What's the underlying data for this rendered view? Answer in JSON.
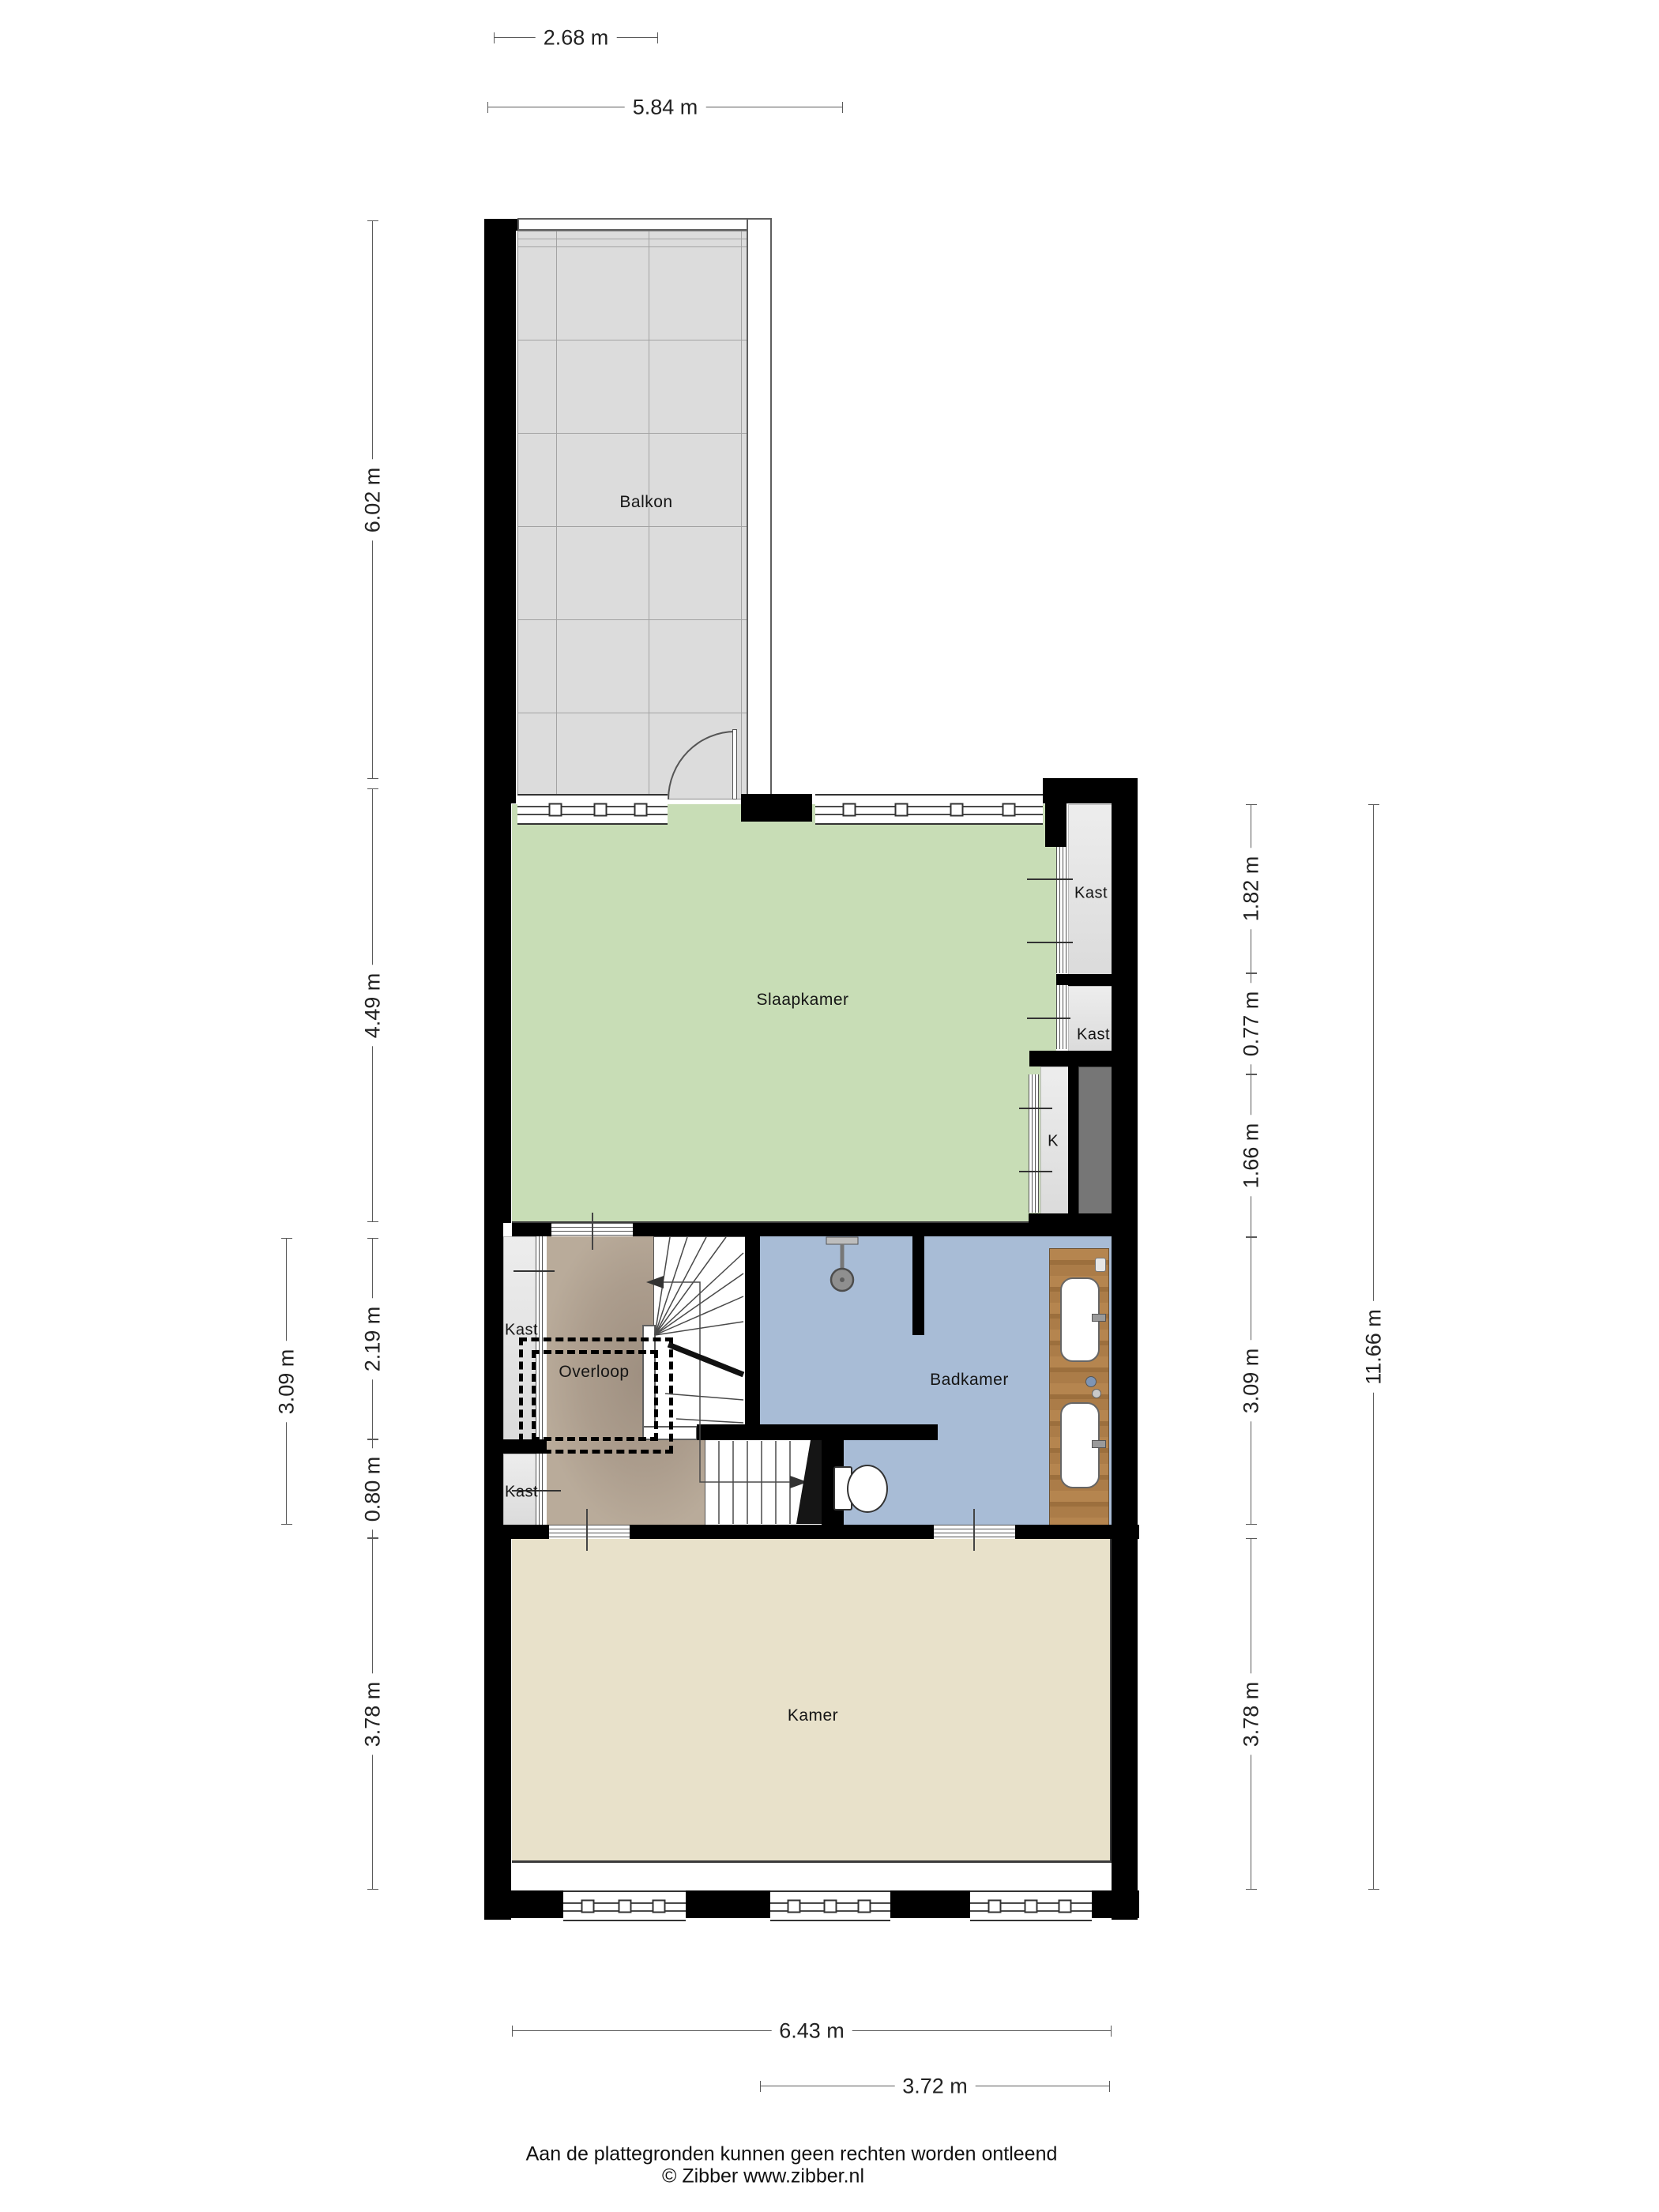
{
  "rooms": {
    "balkon": "Balkon",
    "slaapkamer": "Slaapkamer",
    "badkamer": "Badkamer",
    "overloop": "Overloop",
    "kamer": "Kamer",
    "kast_rechts_boven": "Kast",
    "kast_rechts_onder": "Kast",
    "koof": "K",
    "kast_links_boven": "Kast",
    "kast_links_onder": "Kast"
  },
  "dimensions": {
    "top_balkon": "2.68 m",
    "top_breedte": "5.84 m",
    "left_balkon": "6.02 m",
    "left_slaapkamer": "4.49 m",
    "left_overloop": "2.19 m",
    "left_kast": "0.80 m",
    "left_kamer": "3.78 m",
    "left_buiten": "3.09 m",
    "right_kast_boven": "1.82 m",
    "right_kast_midden": "0.77 m",
    "right_koof": "1.66 m",
    "right_badkamer": "3.09 m",
    "right_kamer": "3.78 m",
    "right_totaal": "11.66 m",
    "bottom_breedte": "6.43 m",
    "bottom_kamer": "3.72 m"
  },
  "footer": {
    "disclaimer": "Aan de plattegronden kunnen geen rechten worden ontleend",
    "copyright": "© Zibber www.zibber.nl"
  },
  "colors": {
    "wall": "#000000",
    "slaapkamer": "#c8ddb6",
    "badkamer": "#a8bcd6",
    "kamer": "#e8e1ca",
    "overloop": "#b9ab9a",
    "balkon": "#dcdcdc",
    "duct": "#767676",
    "wood": "#ab7c48"
  }
}
